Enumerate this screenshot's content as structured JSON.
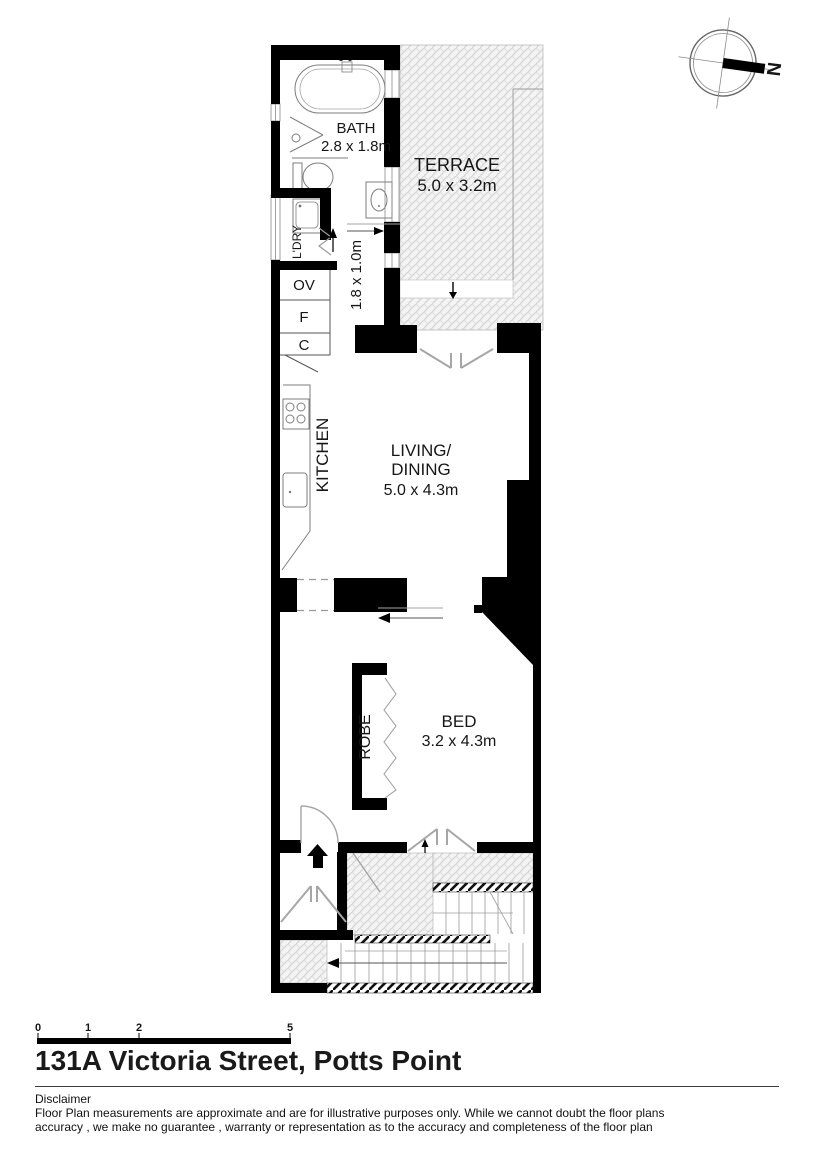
{
  "title": "131A Victoria Street, Potts Point",
  "floor_plan": {
    "rooms": {
      "bath": {
        "name": "BATH",
        "dims": "2.8 x 1.8m"
      },
      "terrace": {
        "name": "TERRACE",
        "dims": "5.0 x 3.2m"
      },
      "hall": {
        "dims": "1.8 x 1.0m"
      },
      "laundry": {
        "name": "L'DRY"
      },
      "kitchen": {
        "name": "KITCHEN"
      },
      "living": {
        "name_line1": "LIVING/",
        "name_line2": "DINING",
        "dims": "5.0 x 4.3m"
      },
      "bed": {
        "name": "BED",
        "dims": "3.2 x 4.3m"
      },
      "robe": {
        "name": "ROBE"
      }
    },
    "cabinets": {
      "oven": "OV",
      "fridge": "F",
      "cupboard": "C"
    },
    "compass": {
      "label": "N"
    }
  },
  "scale_bar": {
    "labels": [
      "0",
      "1",
      "2",
      "5"
    ]
  },
  "disclaimer": {
    "heading": "Disclaimer",
    "line1": "Floor Plan measurements are approximate and are for illustrative purposes only. While we cannot doubt the floor plans",
    "line2": "accuracy , we make no guarantee , warranty or representation as to the accuracy and completeness of the floor plan"
  },
  "colors": {
    "wall": "#000000",
    "door_swing": "#a6a6a6",
    "hatch_line": "#d4d4d4",
    "text": "#111111"
  }
}
